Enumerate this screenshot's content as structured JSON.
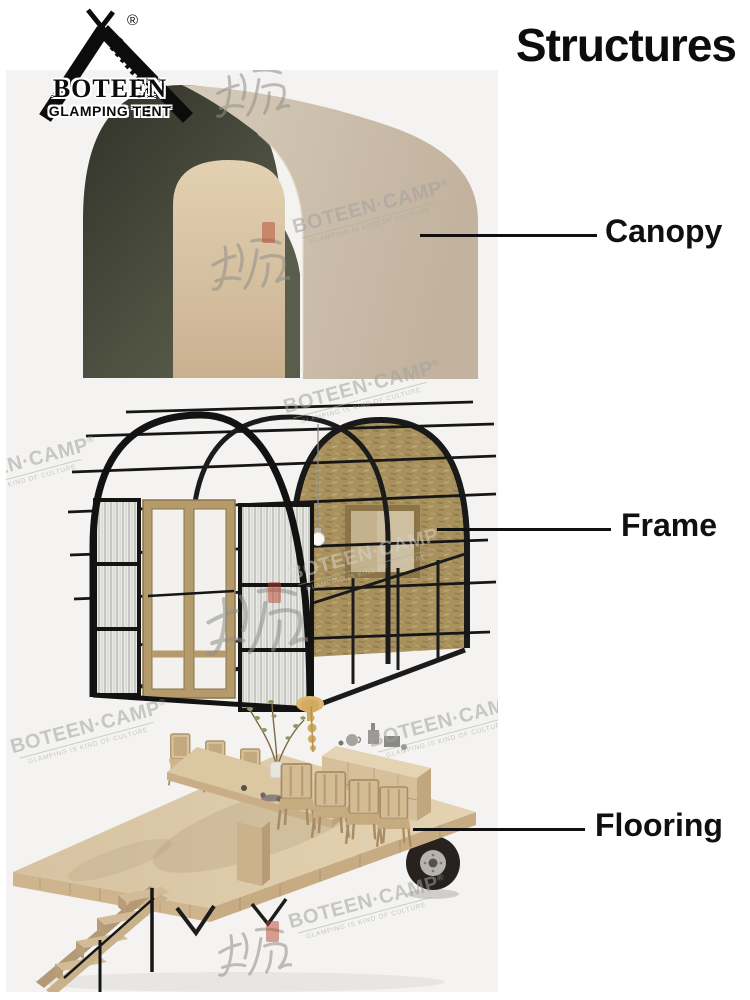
{
  "page": {
    "title": "Structures"
  },
  "brand": {
    "name": "BOTEEN",
    "tagline": "GLAMPING TENT",
    "registered_mark": "®"
  },
  "parts": [
    {
      "label": "Canopy"
    },
    {
      "label": "Frame"
    },
    {
      "label": "Flooring"
    }
  ],
  "watermark": {
    "text": "BOTEEN·CAMP",
    "registered": "®",
    "tagline": "GLAMPING IS KIND OF CULTURE",
    "calligraphy": "博庭"
  },
  "colors": {
    "background": "#ffffff",
    "photo_background": "#f4f3f1",
    "ink": "#111111",
    "canopy_shell": "#cbbca9",
    "canopy_interior": "#44462f",
    "frame_black": "#1b1b1b",
    "osb_panel": "#a8915d",
    "wood_light": "#d8c4a2",
    "watermark_gray": "#a2a29e",
    "seal_red": "#b6462f"
  }
}
